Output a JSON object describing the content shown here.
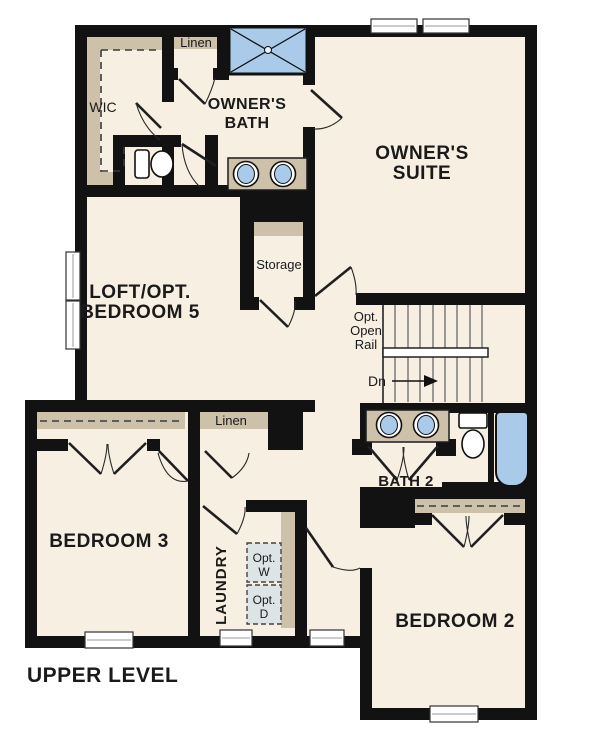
{
  "title": "UPPER LEVEL",
  "colors": {
    "floor": "#f6efe2",
    "wall": "#121212",
    "closet_tan": "#cdc1a9",
    "fixture_blue": "#a9cae9",
    "appliance_gray": "#dde4e6",
    "stair_line": "#7a7a7a",
    "text": "#1a1a1a"
  },
  "rooms": {
    "wic": {
      "label": "WIC"
    },
    "linen_upper": {
      "label": "Linen"
    },
    "owners_bath": {
      "lines": [
        "OWNER'S",
        "BATH"
      ]
    },
    "owners_suite": {
      "lines": [
        "OWNER'S",
        "SUITE"
      ]
    },
    "loft": {
      "lines": [
        "LOFT/OPT.",
        "BEDROOM 5"
      ]
    },
    "storage": {
      "label": "Storage"
    },
    "stairs": {
      "rail_note_lines": [
        "Opt.",
        "Open",
        "Rail"
      ],
      "direction_label": "Dn"
    },
    "bath2": {
      "label": "BATH 2"
    },
    "linen_hall": {
      "label": "Linen"
    },
    "bedroom3": {
      "label": "BEDROOM 3"
    },
    "laundry": {
      "label": "LAUNDRY",
      "washer_lines": [
        "Opt.",
        "W"
      ],
      "dryer_lines": [
        "Opt.",
        "D"
      ]
    },
    "bedroom2": {
      "label": "BEDROOM 2"
    }
  }
}
